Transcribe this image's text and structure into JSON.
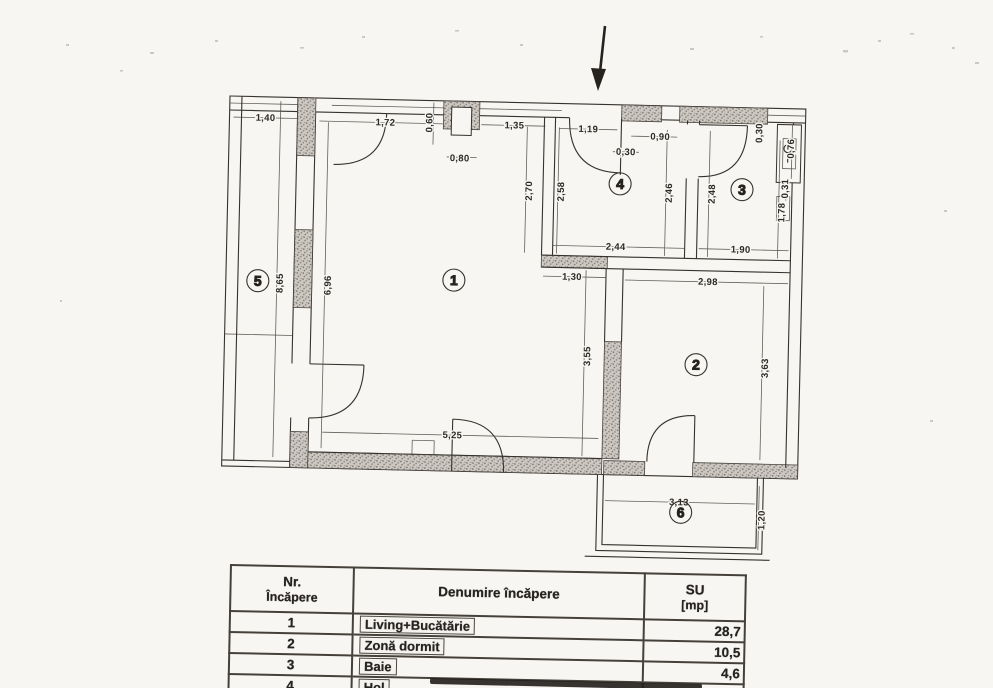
{
  "colors": {
    "ink": "#36322d",
    "paper": "#f7f6f2",
    "wall_fill": "#c9c5be"
  },
  "plan": {
    "entrance_arrow": "down",
    "rooms": [
      "1",
      "2",
      "3",
      "4",
      "5",
      "6"
    ],
    "dims": [
      "1,40",
      "1,72",
      "0,60",
      "0,80",
      "1,35",
      "1,19",
      "0,30",
      "0,90",
      "0,30",
      "0,76",
      "0,31",
      "2,70",
      "2,58",
      "2,46",
      "2,48",
      "1,78",
      "2,44",
      "1,90",
      "1,30",
      "2,98",
      "3,55",
      "3,63",
      "8,65",
      "6,96",
      "5,25",
      "3,13",
      "1,20"
    ]
  },
  "table": {
    "col1_header_line1": "Nr.",
    "col1_header_line2": "Încăpere",
    "col2_header": "Denumire încăpere",
    "col3_header_line1": "SU",
    "col3_header_line2": "[mp]",
    "rows": [
      {
        "nr": "1",
        "name": "Living+Bucătărie",
        "su": "28,7"
      },
      {
        "nr": "2",
        "name": "Zonă dormit",
        "su": "10,5"
      },
      {
        "nr": "3",
        "name": "Baie",
        "su": "4,6"
      },
      {
        "nr": "4",
        "name": "Hol",
        "su": "6,1"
      }
    ]
  }
}
